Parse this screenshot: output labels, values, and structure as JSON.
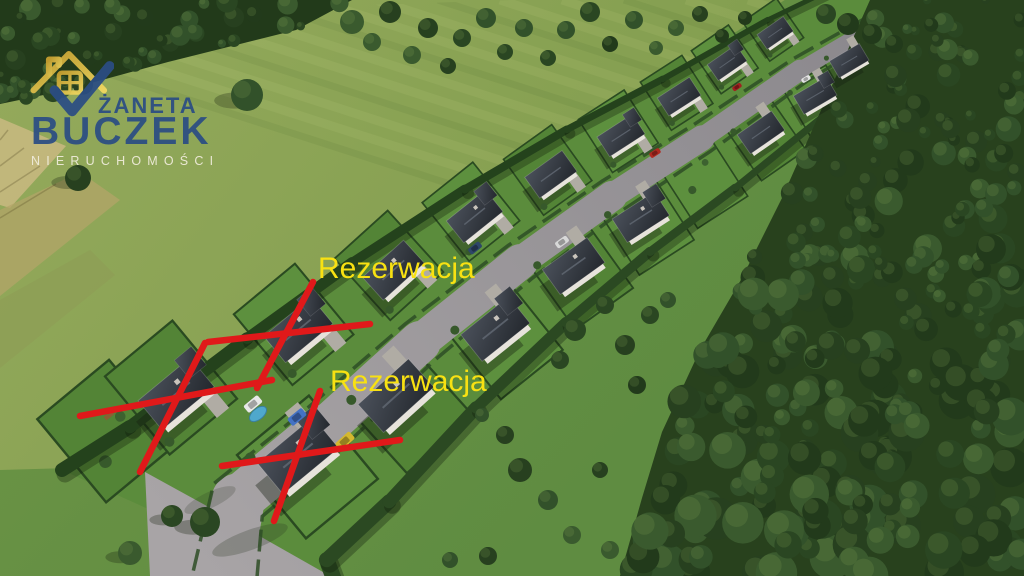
{
  "logo": {
    "icon": "house-check-icon",
    "line1": "ŻANETA",
    "line2": "BUCZEK",
    "line3": "NIERUCHOMOŚCI",
    "colors": {
      "navy": "#2b4d84",
      "gold": "#c9a130",
      "gold_light": "#f3d961",
      "subtitle": "#f0ecdc"
    }
  },
  "annotations": {
    "label_color": "#f8e112",
    "x_color": "#e0191a",
    "labels": [
      {
        "text": "Rezerwacja",
        "x": 318,
        "y": 254
      },
      {
        "text": "Rezerwacja",
        "x": 330,
        "y": 367
      }
    ],
    "x_marks": [
      {
        "strokes": [
          [
            80,
            416,
            272,
            380
          ],
          [
            205,
            343,
            140,
            472
          ]
        ]
      },
      {
        "strokes": [
          [
            208,
            342,
            370,
            324
          ],
          [
            313,
            282,
            257,
            388
          ]
        ]
      },
      {
        "strokes": [
          [
            222,
            466,
            400,
            440
          ],
          [
            320,
            391,
            274,
            521
          ]
        ]
      }
    ]
  }
}
